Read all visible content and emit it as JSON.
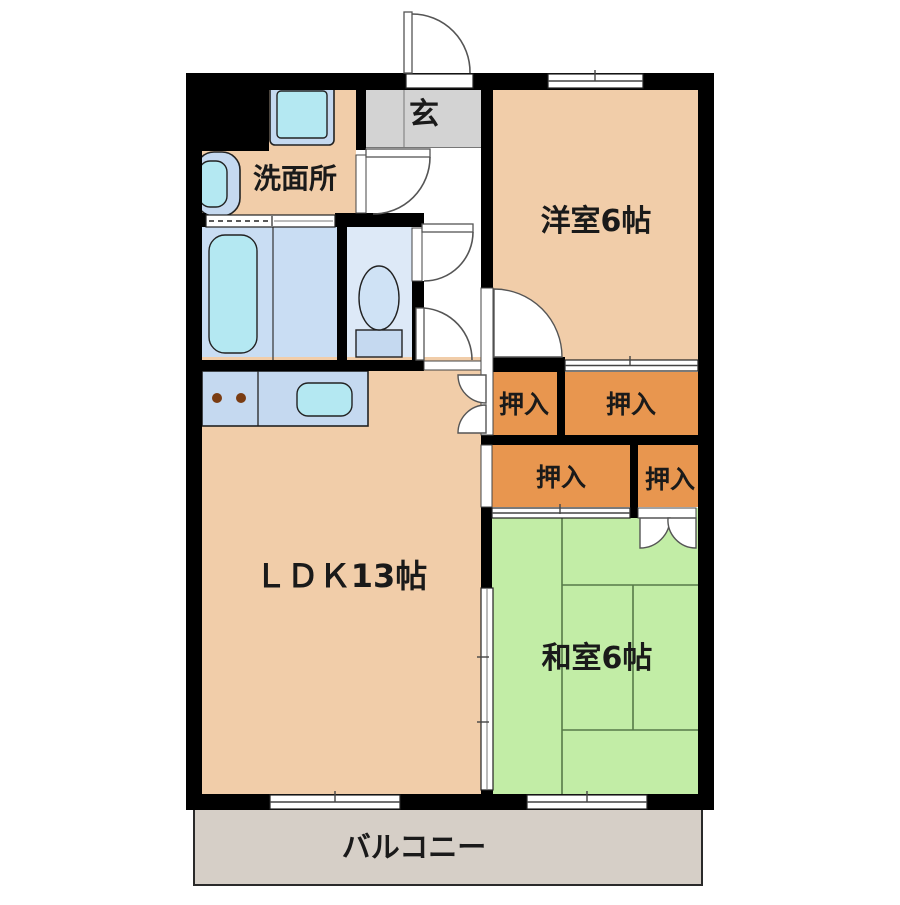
{
  "floorplan": {
    "rooms": {
      "genkan": {
        "label": "玄"
      },
      "washroom": {
        "label": "洗面所"
      },
      "western_room": {
        "label": "洋室6帖"
      },
      "ldk": {
        "label": "ＬＤＫ13帖"
      },
      "japanese_room": {
        "label": "和室6帖"
      },
      "balcony": {
        "label": "バルコニー"
      },
      "closet_top_left": {
        "label": "押入"
      },
      "closet_top_right": {
        "label": "押入"
      },
      "closet_bottom_left": {
        "label": "押入"
      },
      "closet_bottom_right": {
        "label": "押入"
      }
    },
    "colors": {
      "wall": "#000000",
      "floor": "#f1cda9",
      "closet": "#e8964f",
      "tatami": "#c2eda6",
      "genkan": "#d3d3d3",
      "balcony": "#d6cfc7",
      "bathroom": "#c9ddf3",
      "toilet_room": "#dde9f7",
      "fixture_frame": "#c5d9f0",
      "fixture_water": "#b4e8f2"
    }
  }
}
